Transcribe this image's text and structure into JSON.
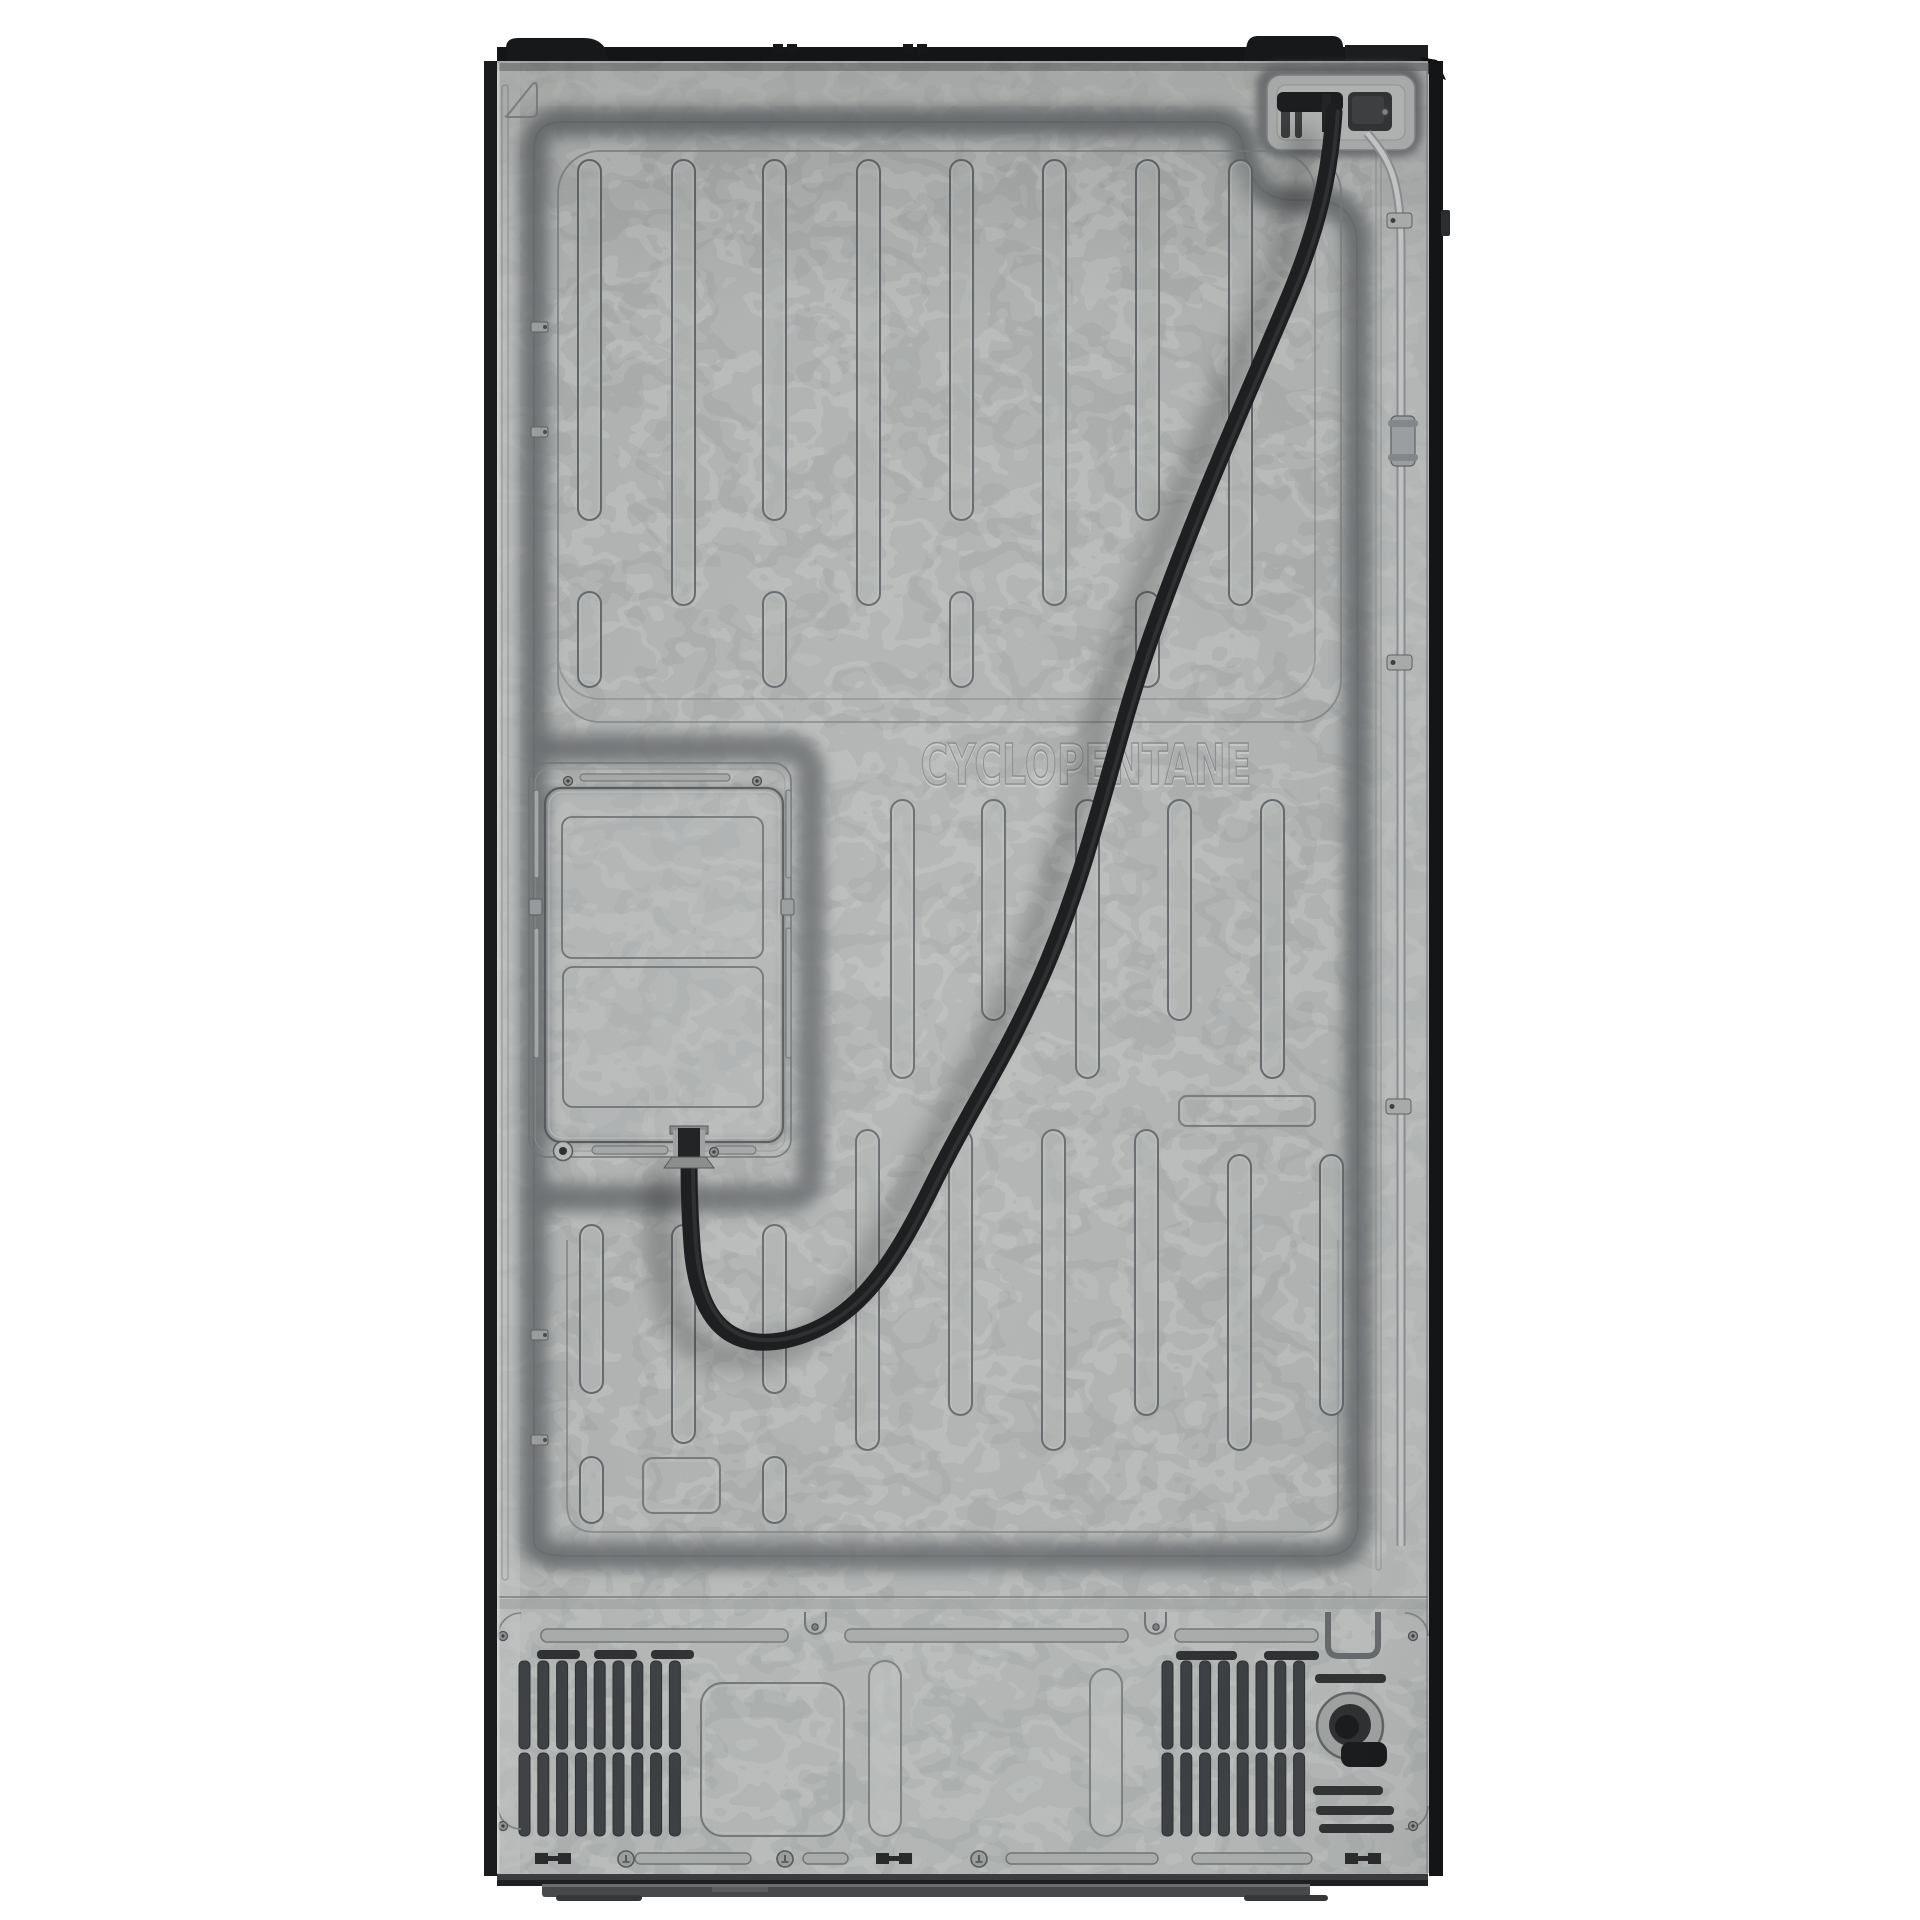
{
  "image": {
    "description": "Product photo: rear view of a refrigerator showing a galvanized steel back panel, power cord, water line and compressor vents",
    "background": "#ffffff"
  },
  "appliance": {
    "embossed_text": "CYCLOPENTANE",
    "power_cord_path": "M 1334 112 C 1330 180 1315 235 1290 295 C 1250 390 1195 510 1150 640 C 1110 755 1093 860 1040 980 C 1000 1068 975 1100 935 1180 C 895 1262 858 1324 785 1340 C 725 1352 697 1315 692 1245 C 689 1205 689 1175 689 1148",
    "water_line_path": "M 1367 133 C 1380 148 1391 163 1396 188 C 1400 208 1401 225 1401 250 L 1401 1546",
    "main_channel_path": "M 534 1542 L 534 150 Q 534 122 562 122 L 1212 122 Q 1240 122 1244 150 Q 1250 196 1288 200 L 1318 200 Q 1354 204 1357 240 L 1358 1520 Q 1358 1556 1322 1556 L 570 1556 Q 534 1556 534 1542 Z",
    "access_channel_path": "M 534 748 L 783 748 Q 811 748 811 776 L 811 1170 Q 811 1198 783 1198 L 534 1198",
    "triangle_emboss_path": "M 507 116 L 531 86 Q 537 79 537 88 L 537 112 Q 537 117 532 117 L 511 117 Q 503 117 507 116 Z",
    "drain_hook_label": "drain-hose-hook",
    "labels": {
      "top_right_pocket": "power-cord-pocket",
      "access_panel": "evaporator-access-panel",
      "left_grille": "compressor-vent-left",
      "right_grille": "compressor-vent-right",
      "drain": "drain-port",
      "cord": "power-cord",
      "water_line": "water-supply-line"
    }
  },
  "palette": {
    "panel_base": "#b1b4b3",
    "panel_bright": "#c2c5c4",
    "flake_light": "#ced1d0",
    "flake_dark": "#7e8182",
    "channel_dark": "#686b6d",
    "line_mid": "#7b7f81",
    "line_dark": "#5f6365",
    "line_light": "#cdd0cf",
    "edge_black": "#17181a",
    "cord_black": "#1d1f21",
    "connector_dark": "#2f3133",
    "slat_dark": "#3d4043",
    "base_dark": "#47494b",
    "tube_light": "#c0c3c2",
    "tube_shade": "#8a8d8f",
    "text_emboss": "#83878a"
  },
  "geometry": {
    "capsule_width": 23,
    "capsules": [
      [
        578,
        160,
        360
      ],
      [
        672,
        160,
        445
      ],
      [
        763,
        160,
        360
      ],
      [
        857,
        160,
        445
      ],
      [
        950,
        160,
        360
      ],
      [
        1043,
        160,
        445
      ],
      [
        1136,
        160,
        360
      ],
      [
        1229,
        160,
        445
      ],
      [
        578,
        592,
        95
      ],
      [
        763,
        592,
        95
      ],
      [
        950,
        592,
        95
      ],
      [
        1136,
        592,
        95
      ],
      [
        891,
        800,
        278
      ],
      [
        982,
        800,
        220
      ],
      [
        1076,
        800,
        278
      ],
      [
        1168,
        800,
        220
      ],
      [
        1261,
        800,
        278
      ],
      [
        856,
        1130,
        320
      ],
      [
        949,
        1130,
        285
      ],
      [
        1042,
        1130,
        320
      ],
      [
        1135,
        1130,
        285
      ],
      [
        1228,
        1155,
        295
      ],
      [
        1320,
        1155,
        260
      ],
      [
        580,
        1225,
        168
      ],
      [
        672,
        1225,
        218
      ],
      [
        763,
        1225,
        168
      ],
      [
        580,
        1457,
        66
      ],
      [
        763,
        1457,
        66
      ]
    ],
    "emboss_rects": [
      [
        1179,
        1096,
        136,
        30,
        8
      ],
      [
        643,
        1458,
        77,
        55,
        10
      ],
      [
        701,
        1683,
        143,
        153,
        22
      ]
    ],
    "tall_capsules": [
      [
        869,
        1661,
        32,
        175
      ],
      [
        1090,
        1669,
        32,
        167
      ]
    ],
    "grilles": [
      {
        "x0": 519,
        "pitch": 18.8,
        "n": 9,
        "rows": [
          [
            1661,
            88
          ],
          [
            1753,
            83
          ]
        ]
      },
      {
        "x0": 1162,
        "pitch": 18.8,
        "n": 8,
        "rows": [
          [
            1661,
            88
          ],
          [
            1753,
            83
          ]
        ]
      }
    ],
    "h_slots_bottom": [
      [
        541,
        1629,
        247
      ],
      [
        845,
        1629,
        283
      ],
      [
        1175,
        1629,
        143
      ]
    ],
    "black_dashes": [
      [
        537,
        1650,
        43
      ],
      [
        594,
        1650,
        43
      ],
      [
        651,
        1650,
        43
      ],
      [
        1176,
        1651,
        61
      ],
      [
        1264,
        1651,
        55
      ],
      [
        1315,
        1674,
        71
      ],
      [
        1313,
        1786,
        70
      ],
      [
        1316,
        1806,
        78
      ],
      [
        1319,
        1824,
        75
      ]
    ],
    "screws": [
      [
        568,
        781
      ],
      [
        757,
        781
      ],
      [
        714,
        1152
      ],
      [
        503,
        1636
      ],
      [
        503,
        1826
      ],
      [
        1413,
        1636
      ],
      [
        1413,
        1826
      ]
    ],
    "small_screws": [
      [
        815,
        1627
      ],
      [
        1156,
        1627
      ],
      [
        1385,
        112
      ]
    ],
    "washer_screw": [
      563,
      1151
    ],
    "grounds": [
      [
        626,
        1859
      ],
      [
        785,
        1859
      ],
      [
        979,
        1859
      ]
    ],
    "h_clips": [
      [
        535,
        1853
      ],
      [
        876,
        1853
      ],
      [
        1345,
        1853
      ]
    ],
    "bottom_ovals": [
      [
        635,
        1853,
        116
      ],
      [
        803,
        1853,
        45
      ],
      [
        1006,
        1853,
        152
      ],
      [
        1192,
        1853,
        120
      ]
    ],
    "left_channel_clips": [
      [
        531,
        322
      ],
      [
        531,
        427
      ],
      [
        531,
        1330
      ],
      [
        531,
        1435
      ]
    ],
    "water_clips": [
      [
        1387,
        213
      ],
      [
        1387,
        655
      ],
      [
        1386,
        1099
      ]
    ],
    "water_union": [
      1391,
      416,
      24,
      50
    ],
    "pocket_vent_slots": [
      [
        1281,
        92,
        9,
        46
      ],
      [
        1295,
        92,
        7,
        46
      ]
    ],
    "cap_tabs": [
      [
        773,
        44
      ],
      [
        787,
        44
      ],
      [
        903,
        44
      ],
      [
        917,
        44
      ]
    ],
    "access_slits": [
      [
        534,
        790,
        5,
        88
      ],
      [
        786,
        790,
        5,
        88
      ],
      [
        534,
        928,
        5,
        130
      ],
      [
        786,
        928,
        5,
        130
      ],
      [
        580,
        774,
        150,
        7
      ],
      [
        592,
        1146,
        76,
        8
      ],
      [
        714,
        1146,
        42,
        8
      ]
    ],
    "plate_side_clips": [
      [
        529,
        899,
        13,
        16
      ],
      [
        781,
        899,
        13,
        16
      ]
    ],
    "notches_x": [
      805,
      1145
    ],
    "corner_contours": [
      "M 521 1613 A 23 23 0 0 0 498 1636",
      "M 498 1806 A 23 23 0 0 0 521 1829",
      "M 1405 1613 A 23 23 0 0 1 1428 1636",
      "M 1428 1806 A 23 23 0 0 1 1405 1829"
    ]
  }
}
